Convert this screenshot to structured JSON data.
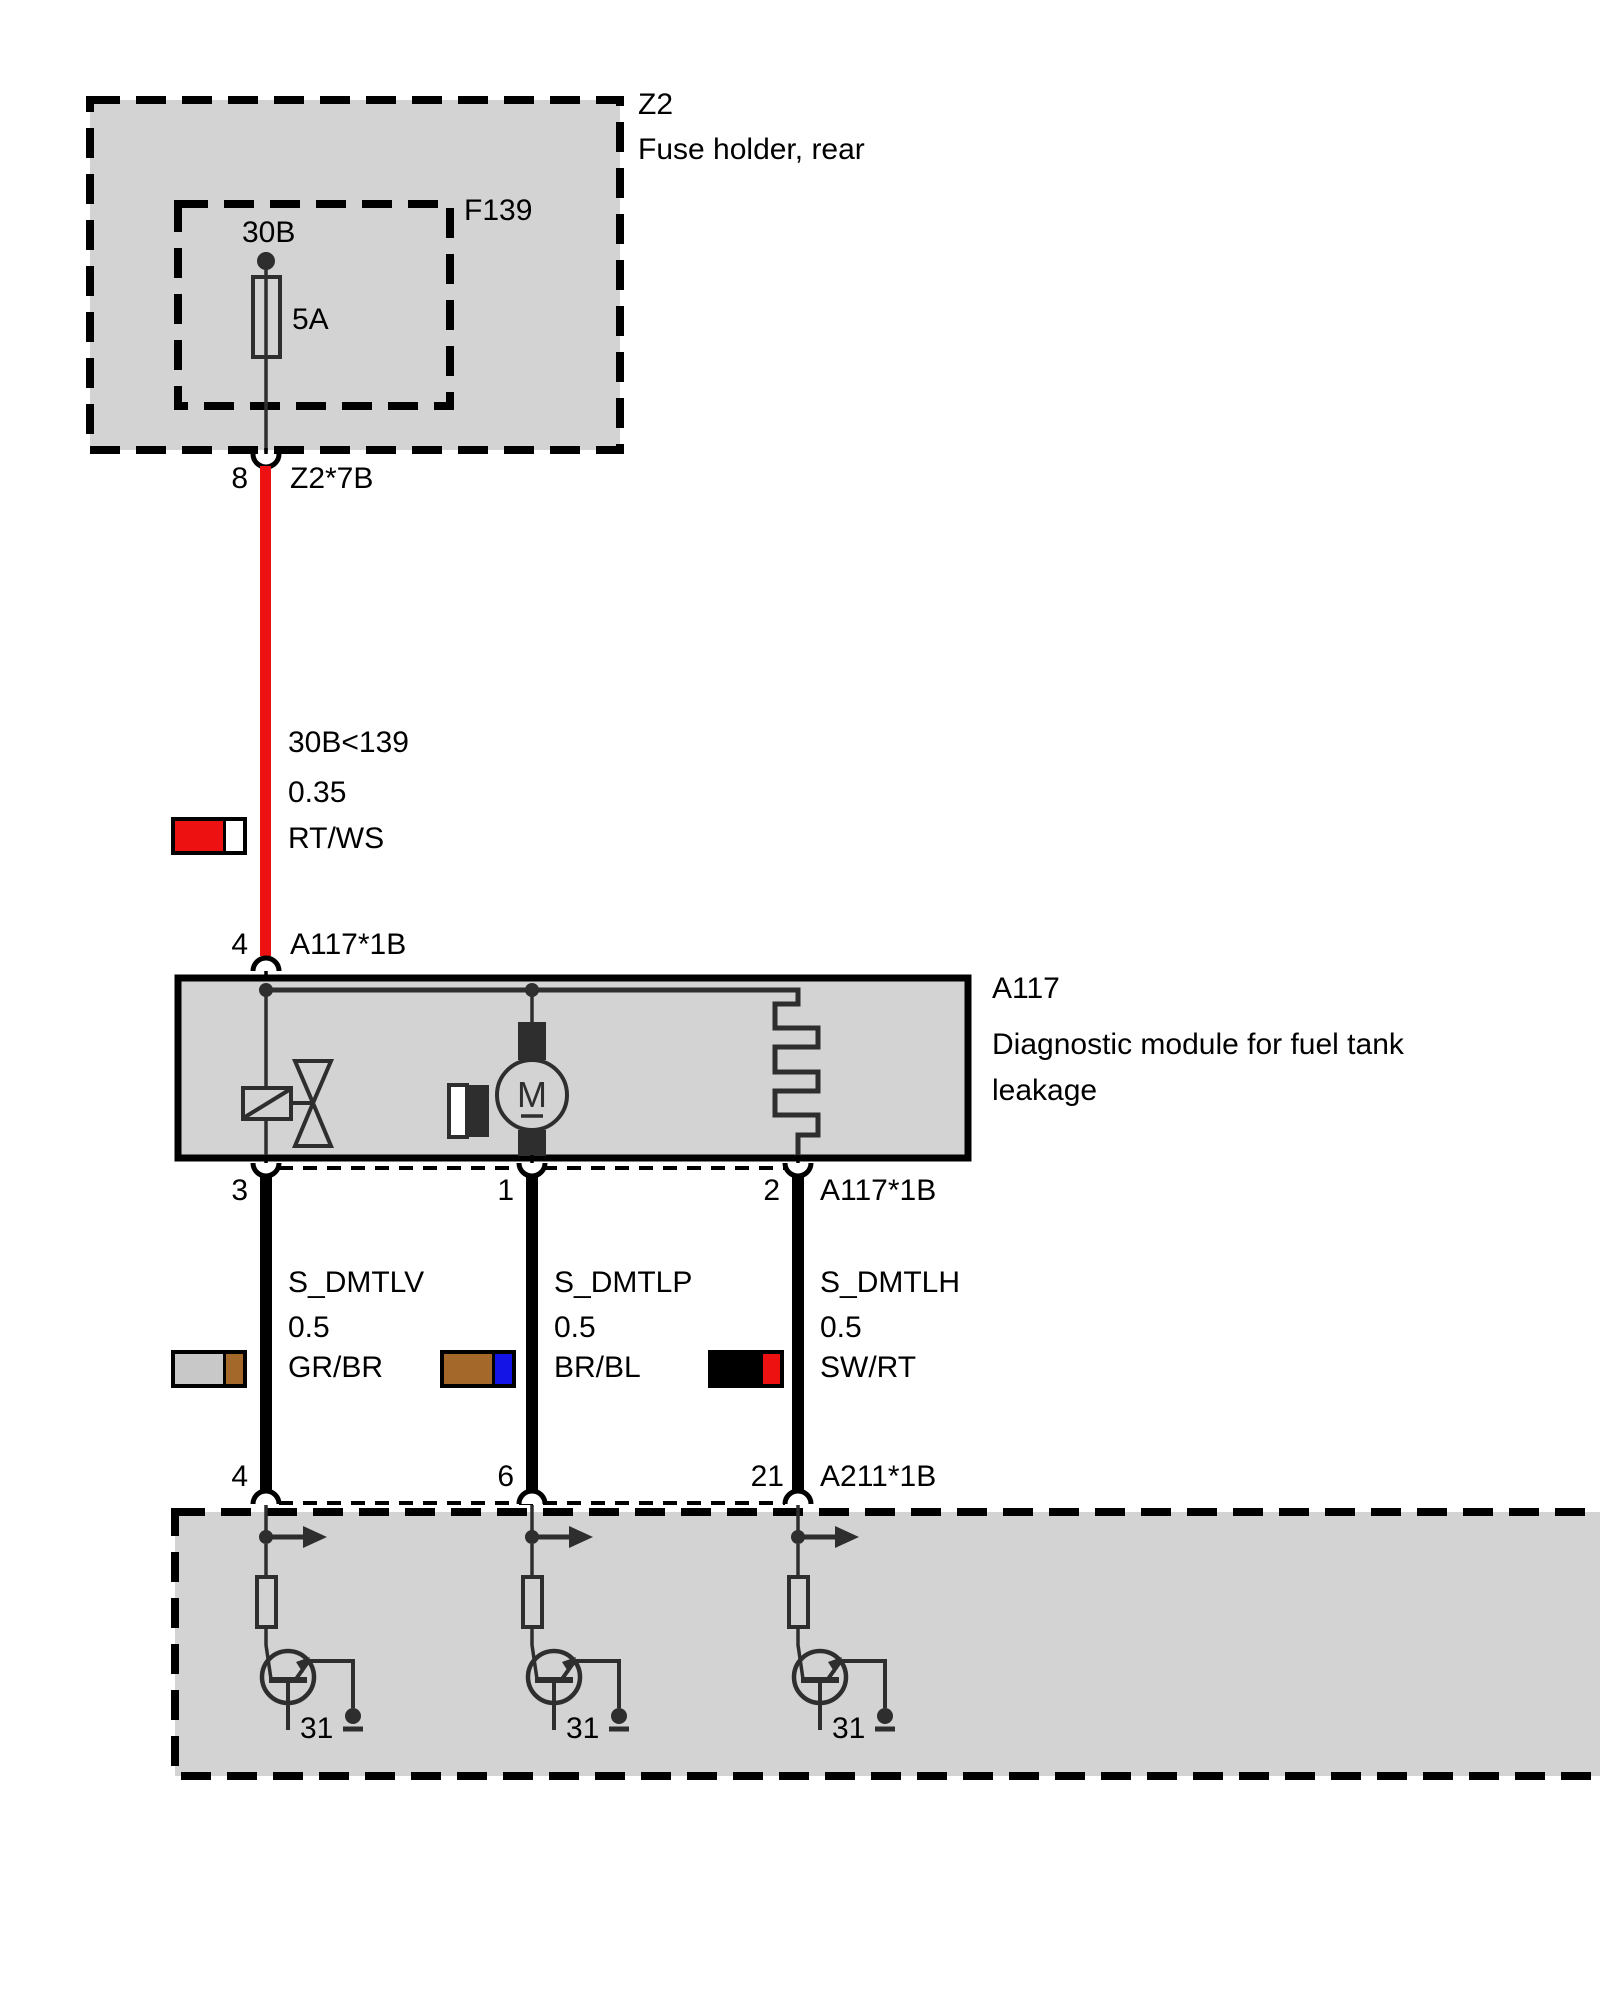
{
  "fuse_holder": {
    "ref": "Z2",
    "desc": "Fuse holder, rear",
    "fuse_ref": "F139",
    "terminal": "30B",
    "rating": "5A"
  },
  "top_connector": {
    "pin": "8",
    "name": "Z2*7B"
  },
  "main_wire": {
    "circuit": "30B<139",
    "gauge": "0.35",
    "code": "RT/WS",
    "color_left": "#ee1111",
    "color_right": "#ffffff"
  },
  "module": {
    "ref": "A117",
    "desc_line1": "Diagnostic module for fuel tank",
    "desc_line2": "leakage",
    "motor_label": "M",
    "in_pin": "4",
    "in_connector": "A117*1B",
    "out_pin_1": "3",
    "out_pin_2": "1",
    "out_pin_3": "2",
    "out_connector": "A117*1B"
  },
  "signal_wires": {
    "w1": {
      "name": "S_DMTLV",
      "gauge": "0.5",
      "code": "GR/BR",
      "color_left": "#c8c8c8",
      "color_right": "#a3682a",
      "pin": "4"
    },
    "w2": {
      "name": "S_DMTLP",
      "gauge": "0.5",
      "code": "BR/BL",
      "color_left": "#a3682a",
      "color_right": "#1414e6",
      "pin": "6"
    },
    "w3": {
      "name": "S_DMTLH",
      "gauge": "0.5",
      "code": "SW/RT",
      "color_left": "#000000",
      "color_right": "#ee1111",
      "pin": "21"
    }
  },
  "bottom_connector": "A211*1B",
  "ground_terminal": "31",
  "colors": {
    "module_fill": "#d3d3d3",
    "wire_red": "#ee1111",
    "symbol": "#2e2e2e"
  }
}
